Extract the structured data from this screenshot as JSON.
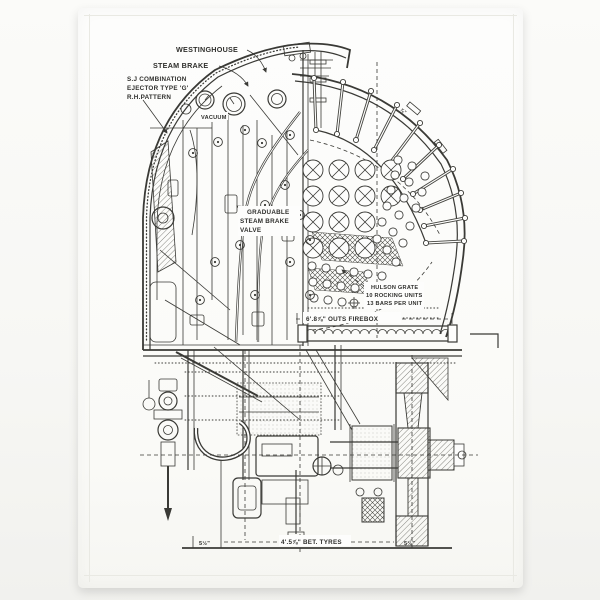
{
  "product": {
    "subject": "Steam locomotive firebox and cab cross-section engineering drawing printed on a white tea towel",
    "colors": {
      "background": "#f7f7f5",
      "towel": "#fcfcfa",
      "ink": "#3a3a36"
    }
  },
  "diagram": {
    "labels": {
      "westinghouse": "WESTINGHOUSE",
      "steam_brake": "STEAM BRAKE",
      "ejector": [
        "S.J COMBINATION",
        "EJECTOR TYPE 'G'",
        "R.H.PATTERN"
      ],
      "vacuum": "VACUUM",
      "graduable_valve": [
        "GRADUABLE",
        "STEAM BRAKE",
        "VALVE"
      ],
      "hulson_grate": [
        "HULSON GRATE",
        "10 ROCKING UNITS",
        "13 BARS PER UNIT"
      ],
      "firebox_width": "6'.8⅞\" OUTS FIREBOX",
      "between_tyres": "4'.5⅞\" BET. TYRES",
      "tyre_width_left": "5½\"",
      "tyre_width_right": "5½\"",
      "stay_note": "⅞\""
    }
  }
}
